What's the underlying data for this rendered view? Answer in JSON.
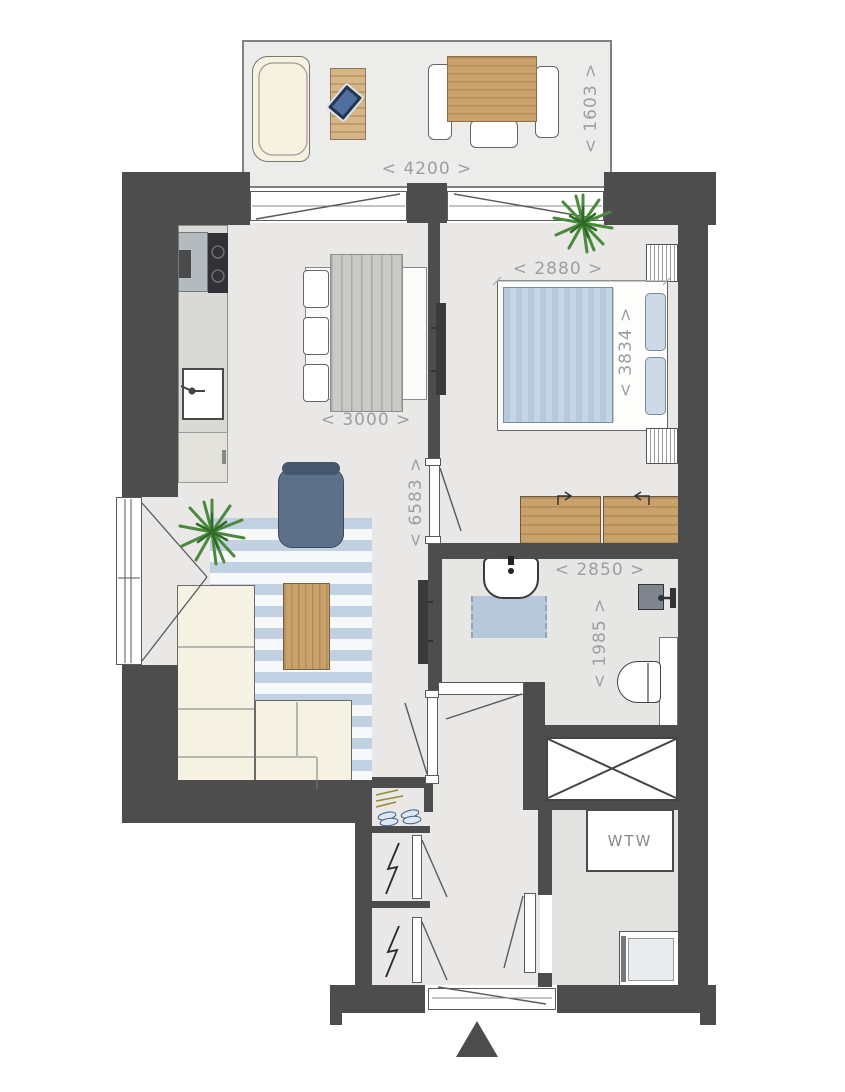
{
  "plan": {
    "colors": {
      "wall": "#4d4d4d",
      "floor": "#e9e8e6",
      "wood": "#c9a16b",
      "textile_blue": "#b9cede",
      "label_gray": "#9e9e9e"
    },
    "labels": {
      "balcony_width": "< 4200 >",
      "balcony_depth": "< 1603 >",
      "bedroom_width": "< 2880 >",
      "bedroom_depth": "< 3834 >",
      "dining_width": "< 3000 >",
      "living_depth": "< 6583 >",
      "bathroom_width": "< 2850 >",
      "bathroom_depth": "< 1985 >",
      "heat_recovery_unit": "WTW"
    }
  }
}
